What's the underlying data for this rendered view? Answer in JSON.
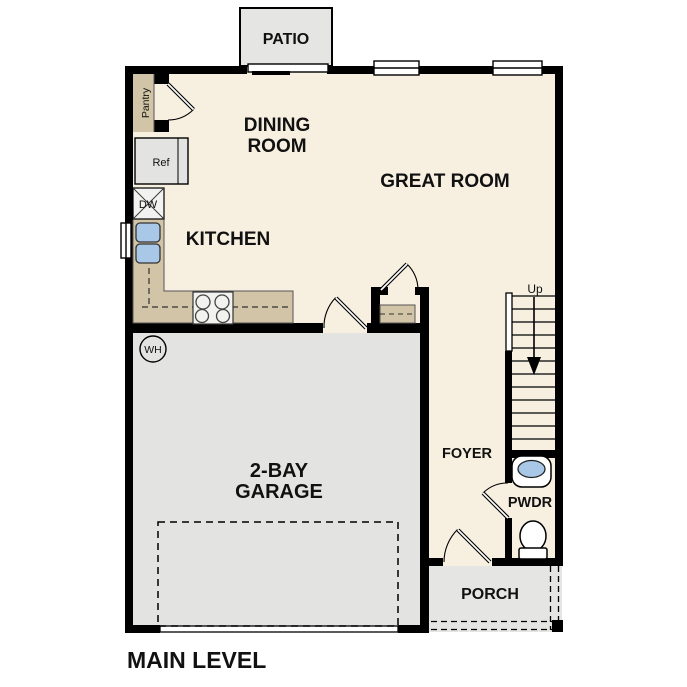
{
  "title": "MAIN LEVEL",
  "colors": {
    "wall": "#000000",
    "floor": "#f7f0e1",
    "outdoor": "#e5e5e3",
    "garage_floor": "#e3e3e1",
    "counter": "#d2c4a6",
    "sink_blue": "#a9c8e8",
    "appliance": "#f2f2f0",
    "fixture_white": "#ffffff"
  },
  "rooms": {
    "patio": "PATIO",
    "dining_line1": "DINING",
    "dining_line2": "ROOM",
    "great_room": "GREAT ROOM",
    "kitchen": "KITCHEN",
    "garage_line1": "2-BAY",
    "garage_line2": "GARAGE",
    "foyer": "FOYER",
    "powder": "PWDR",
    "porch": "PORCH"
  },
  "fixtures": {
    "pantry": "Pantry",
    "refrigerator": "Ref",
    "dishwasher": "DW",
    "water_heater": "WH",
    "stairs_direction": "Up"
  }
}
